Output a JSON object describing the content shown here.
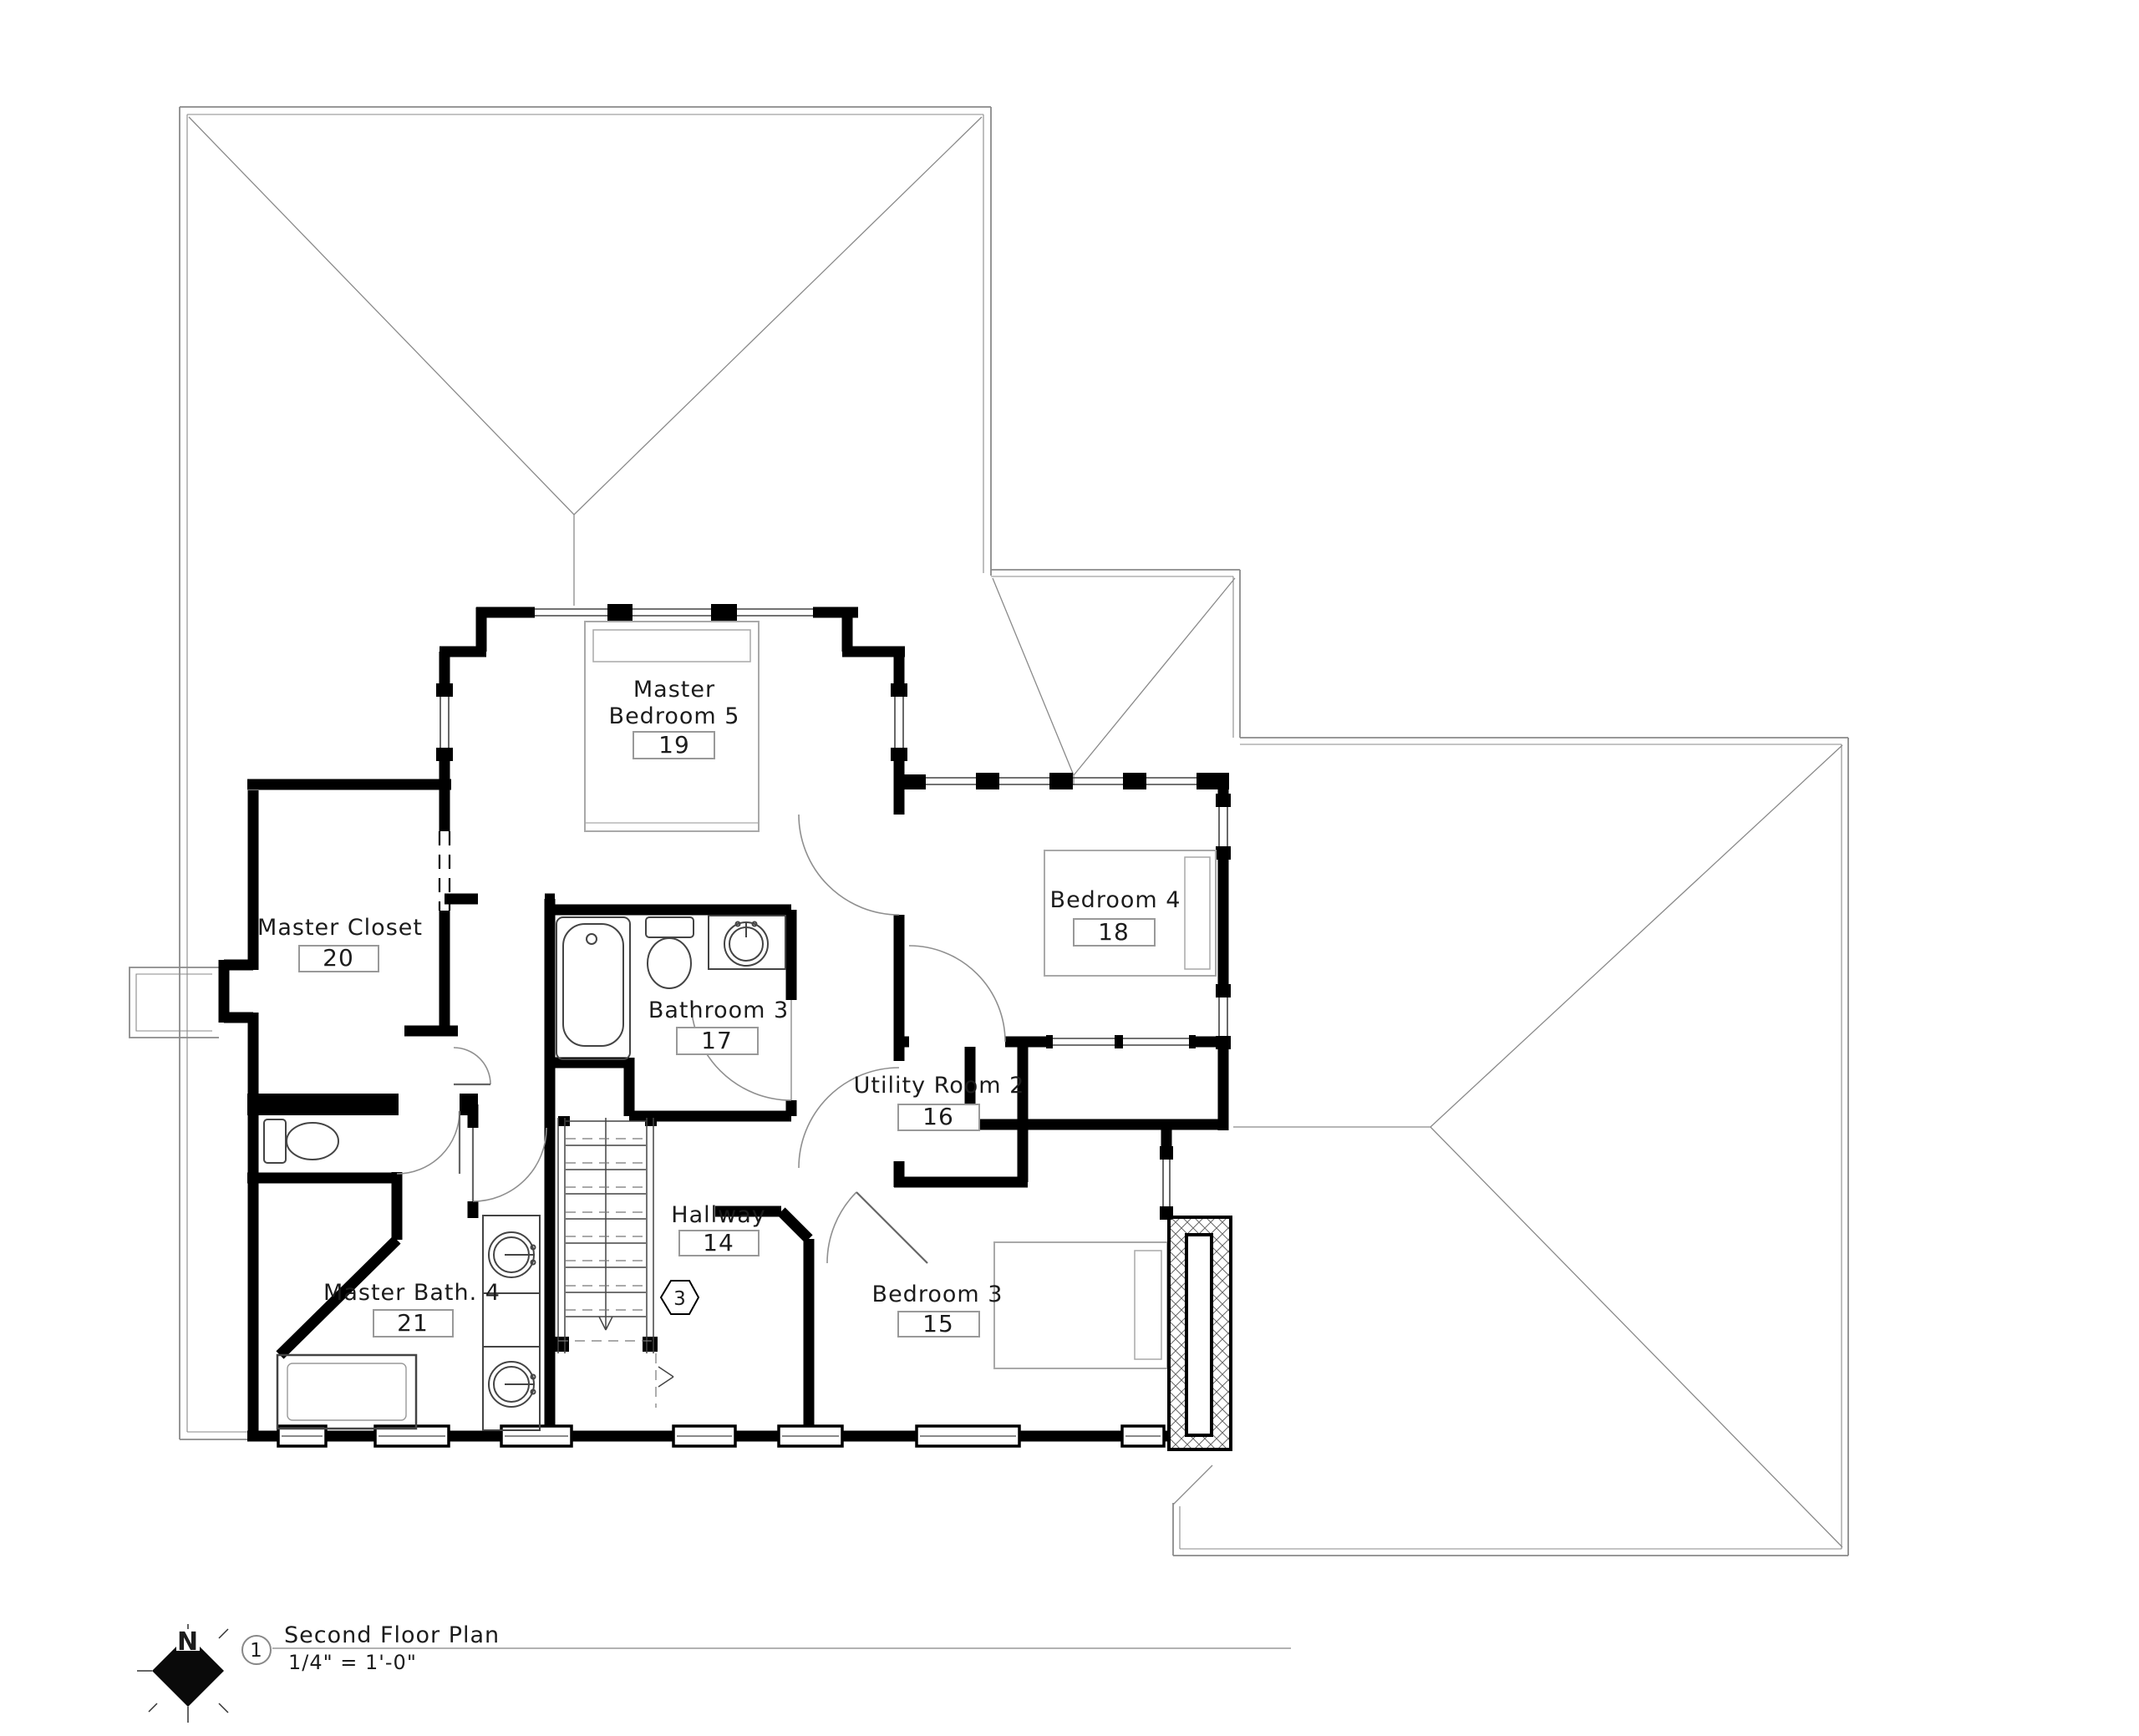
{
  "drawing": {
    "sheet_title": "Second Floor Plan",
    "scale_label": "1/4\" = 1'-0\"",
    "detail_number": "1",
    "north_label": "N",
    "stair_tag": "3"
  },
  "rooms": [
    {
      "id": "master-bedroom",
      "line1": "Master",
      "line2": "Bedroom 5",
      "number": "19"
    },
    {
      "id": "master-closet",
      "line1": "Master Closet",
      "number": "20"
    },
    {
      "id": "bathroom-3",
      "line1": "Bathroom 3",
      "number": "17"
    },
    {
      "id": "bedroom-4",
      "line1": "Bedroom 4",
      "number": "18"
    },
    {
      "id": "utility-room-2",
      "line1": "Utility Room 2",
      "number": "16"
    },
    {
      "id": "hallway",
      "line1": "Hallway",
      "number": "14"
    },
    {
      "id": "master-bath-4",
      "line1": "Master Bath. 4",
      "number": "21"
    },
    {
      "id": "bedroom-3",
      "line1": "Bedroom 3",
      "number": "15"
    }
  ],
  "colors": {
    "wall": "#000000",
    "roof_line": "#8a8a8a",
    "thin_line": "#444444",
    "furniture_line": "#a9a9a9",
    "label_box_border": "#999999",
    "text": "#1c1c1c",
    "background": "#ffffff"
  }
}
